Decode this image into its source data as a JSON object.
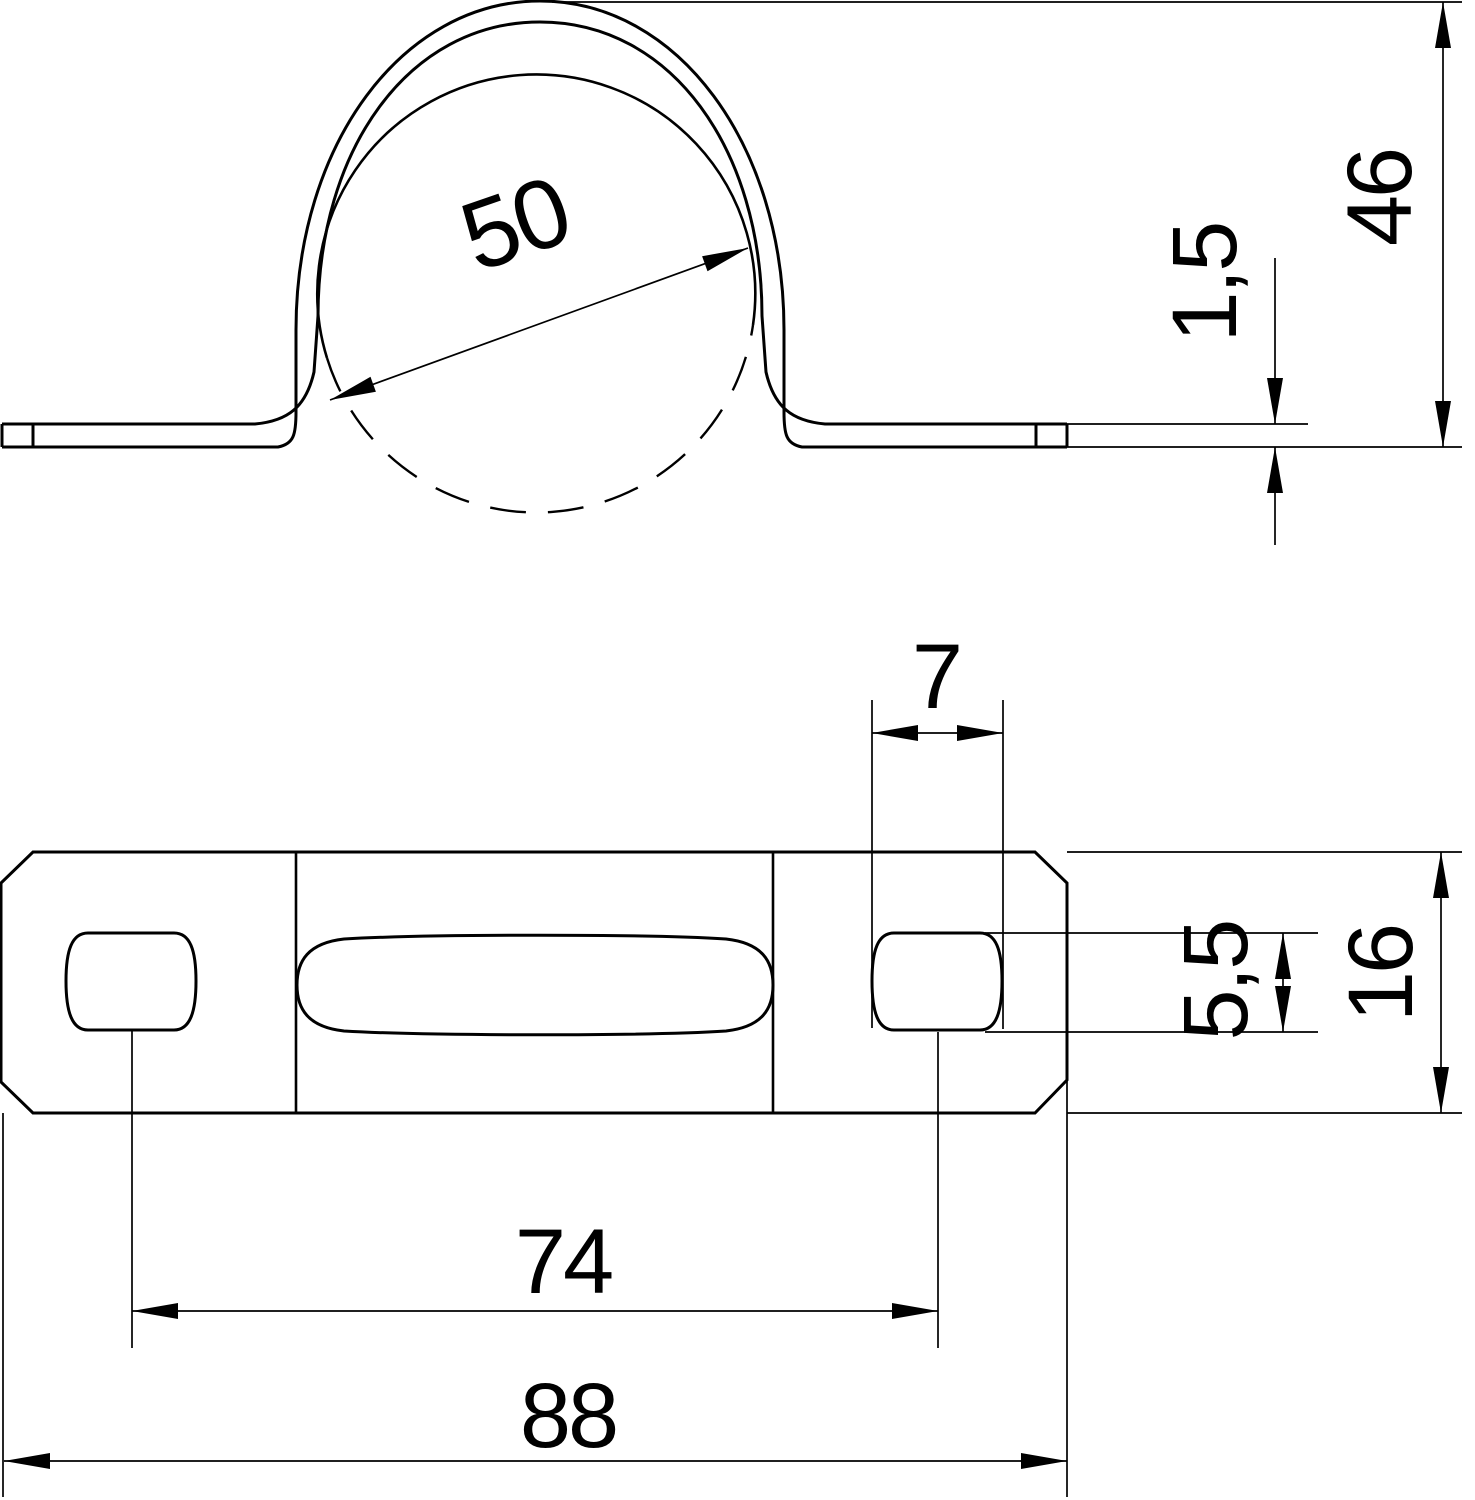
{
  "drawing": {
    "background": "#ffffff",
    "line_color": "#000000",
    "side_view": {
      "pipe_diameter": "50",
      "overall_height": "46",
      "material_thickness": "1,5"
    },
    "plan_view": {
      "hole_width": "7",
      "hole_height": "5,5",
      "strap_width": "16",
      "hole_spacing": "74",
      "overall_length": "88"
    }
  }
}
